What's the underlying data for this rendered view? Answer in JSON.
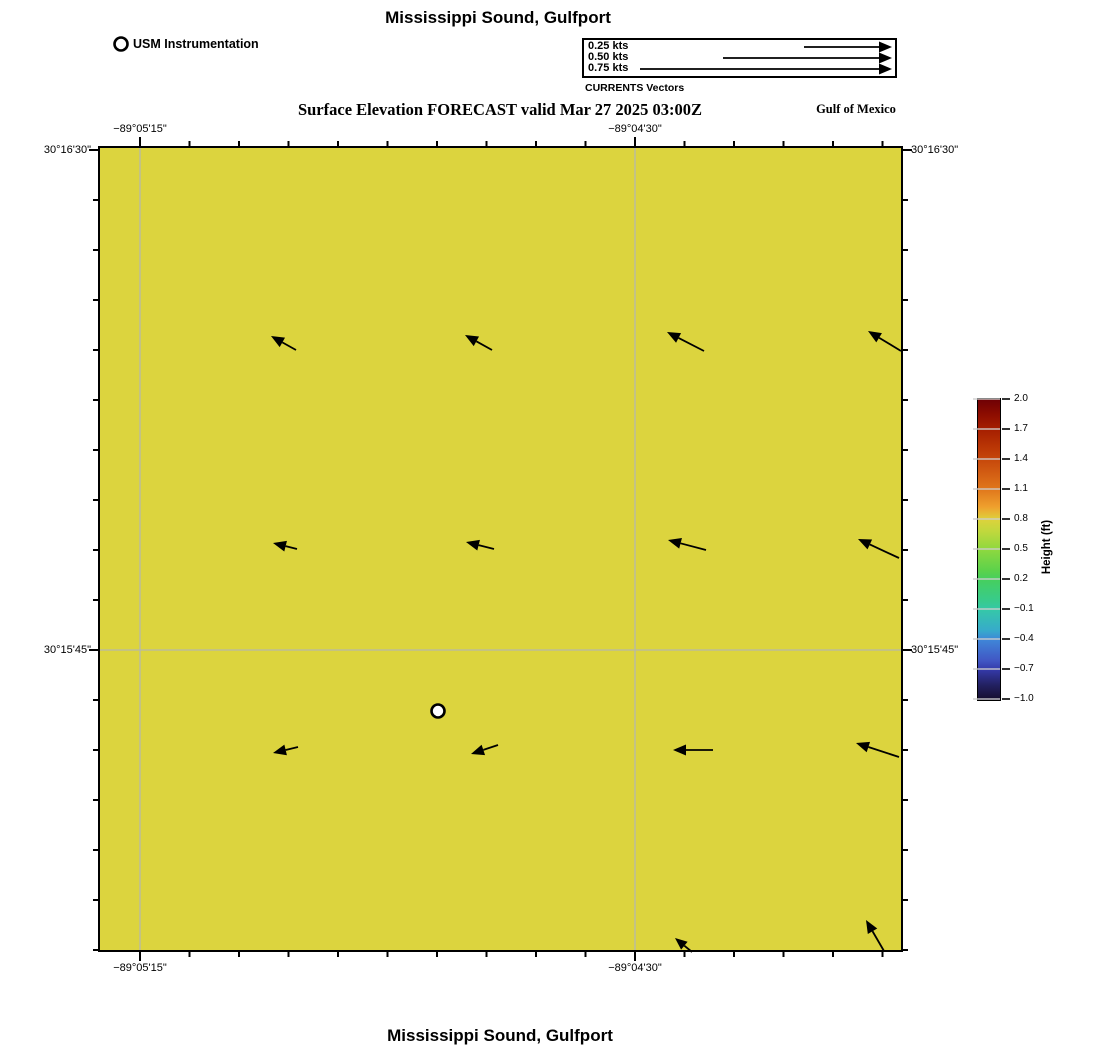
{
  "colors": {
    "map_fill": "#dcd43e",
    "grid": "#b6b8ab",
    "axis": "#000000",
    "marker_fill": "#ffffff"
  },
  "header": {
    "title": "Mississippi Sound, Gulfport",
    "instrument_label": "USM Instrumentation",
    "instrument_marker": {
      "x": 121,
      "y": 44
    },
    "vector_legend": {
      "items": [
        {
          "label": "0.25 kts",
          "y": 47,
          "tail_x": 804
        },
        {
          "label": "0.50 kts",
          "y": 58,
          "tail_x": 723
        },
        {
          "label": "0.75 kts",
          "y": 69,
          "tail_x": 640
        }
      ],
      "tip_x": 892,
      "label_x": 588,
      "caption": "CURRENTS Vectors"
    },
    "subtitle": "Surface Elevation FORECAST valid Mar 27 2025 03:00Z",
    "region_label": "Gulf of Mexico"
  },
  "map": {
    "geom": {
      "left": 100,
      "top": 148,
      "right": 901,
      "bottom": 950
    },
    "grid_x": [
      140,
      635
    ],
    "grid_y": [
      650
    ],
    "top_ticks_x": [
      140,
      189.5,
      239,
      288.5,
      338,
      387.5,
      437,
      486.5,
      536,
      585.5,
      635,
      684.5,
      734,
      783.5,
      833,
      882.5
    ],
    "side_ticks_y": [
      150,
      200,
      250,
      300,
      350,
      400,
      450,
      500,
      550,
      600,
      650,
      700,
      750,
      800,
      850,
      900,
      950
    ],
    "major_x": [
      140,
      635
    ],
    "major_y": [
      150,
      650
    ],
    "x_labels": [
      {
        "text": "−89°05'15\"",
        "x": 140
      },
      {
        "text": "−89°04'30\"",
        "x": 635
      }
    ],
    "y_labels": [
      {
        "text": "30°16'30\"",
        "y": 150
      },
      {
        "text": "30°15'45\"",
        "y": 650
      }
    ],
    "arrows": [
      [
        296,
        350,
        271,
        336
      ],
      [
        492,
        350,
        465,
        335
      ],
      [
        704,
        351,
        667,
        332
      ],
      [
        901,
        351,
        868,
        331
      ],
      [
        297,
        549,
        273,
        543
      ],
      [
        494,
        549,
        466,
        542
      ],
      [
        706,
        550,
        668,
        540
      ],
      [
        899,
        558,
        858,
        539
      ],
      [
        298,
        747,
        273,
        753
      ],
      [
        498,
        745,
        471,
        754
      ],
      [
        713,
        750,
        673,
        750
      ],
      [
        899,
        757,
        856,
        743
      ],
      [
        692,
        952,
        675,
        938
      ],
      [
        884,
        951,
        866,
        920
      ]
    ],
    "station": {
      "x": 438,
      "y": 711
    }
  },
  "colorbar": {
    "label": "Height (ft)",
    "left": 978,
    "top": 399,
    "width": 22,
    "step": 30,
    "ticks": [
      "2.0",
      "1.7",
      "1.4",
      "1.1",
      "0.8",
      "0.5",
      "0.2",
      "−0.1",
      "−0.4",
      "−0.7",
      "−1.0"
    ],
    "stops": [
      [
        0.0,
        "#6e0005"
      ],
      [
        0.05,
        "#8c0c00"
      ],
      [
        0.1,
        "#a51e00"
      ],
      [
        0.17,
        "#bd3a06"
      ],
      [
        0.23,
        "#ce5510"
      ],
      [
        0.3,
        "#e0771c"
      ],
      [
        0.36,
        "#efa12e"
      ],
      [
        0.4,
        "#ddd23c"
      ],
      [
        0.44,
        "#c0d83d"
      ],
      [
        0.5,
        "#8ed83f"
      ],
      [
        0.57,
        "#5cd24b"
      ],
      [
        0.6,
        "#46cf5e"
      ],
      [
        0.67,
        "#38cb8c"
      ],
      [
        0.7,
        "#35c8a8"
      ],
      [
        0.77,
        "#37aacb"
      ],
      [
        0.8,
        "#3f86d8"
      ],
      [
        0.87,
        "#4156c4"
      ],
      [
        0.9,
        "#3439a8"
      ],
      [
        0.95,
        "#232162"
      ],
      [
        1.0,
        "#150d2c"
      ]
    ]
  },
  "footer": {
    "title": "Mississippi Sound, Gulfport"
  },
  "chart_data": {
    "type": "heatmap",
    "title": "Mississippi Sound, Gulfport",
    "subtitle": "Surface Elevation FORECAST valid Mar 27 2025 03:00Z",
    "field": "surface elevation with surface current vectors",
    "uniform_field_value_estimate_ft": 0.8,
    "x_axis": {
      "label": "longitude",
      "ticks": [
        "−89°05'15\"",
        "−89°04'30\""
      ]
    },
    "y_axis": {
      "label": "latitude",
      "ticks": [
        "30°16'30\"",
        "30°15'45\""
      ]
    },
    "colorbar": {
      "label": "Height (ft)",
      "range": [
        -1.0,
        2.0
      ],
      "tick_values": [
        2.0,
        1.7,
        1.4,
        1.1,
        0.8,
        0.5,
        0.2,
        -0.1,
        -0.4,
        -0.7,
        -1.0
      ]
    },
    "vector_scale_kts": [
      0.25,
      0.5,
      0.75
    ],
    "vector_scale_px_per_kt": 340,
    "station": "USM Instrumentation",
    "region_label": "Gulf of Mexico",
    "legend_position": "top",
    "grid": true
  }
}
